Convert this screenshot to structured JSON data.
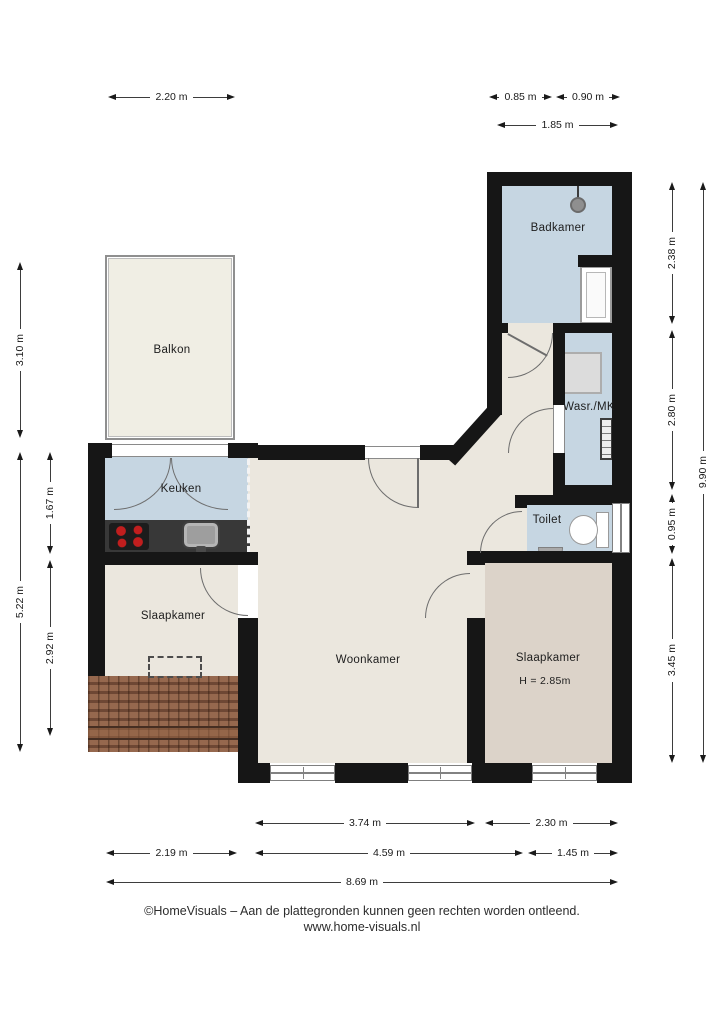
{
  "plan": {
    "rooms": {
      "balkon": {
        "label": "Balkon"
      },
      "badkamer": {
        "label": "Badkamer"
      },
      "keuken": {
        "label": "Keuken"
      },
      "wasruimte": {
        "label": "Wasr./MK"
      },
      "toilet": {
        "label": "Toilet"
      },
      "slaapkamer_links": {
        "label": "Slaapkamer"
      },
      "woonkamer": {
        "label": "Woonkamer"
      },
      "slaapkamer_rechts": {
        "label": "Slaapkamer",
        "height_note": "H = 2.85m"
      }
    },
    "dimensions": {
      "top": [
        "2.20 m",
        "0.85 m",
        "0.90 m",
        "1.85 m"
      ],
      "left": [
        "3.10 m",
        "5.22 m",
        "1.67 m",
        "2.92 m"
      ],
      "right": [
        "2.38 m",
        "2.80 m",
        "0.95 m",
        "3.45 m",
        "9.90 m"
      ],
      "bottom": [
        "3.74 m",
        "2.30 m",
        "2.19 m",
        "4.59 m",
        "1.45 m",
        "8.69 m"
      ]
    },
    "colors": {
      "wall": "#161616",
      "wet_room_floor": "#c6d6e2",
      "living_floor": "#ebe7de",
      "bedroom_right_floor": "#dcd3c9",
      "balkon_floor": "#f0eee4",
      "roof_tiles": "#8a5c44",
      "kitchen_counter": "#383838",
      "burner_red": "#c11e1e"
    }
  },
  "footer": {
    "line1": "©HomeVisuals – Aan de plattegronden kunnen geen rechten worden ontleend.",
    "line2": "www.home-visuals.nl"
  }
}
